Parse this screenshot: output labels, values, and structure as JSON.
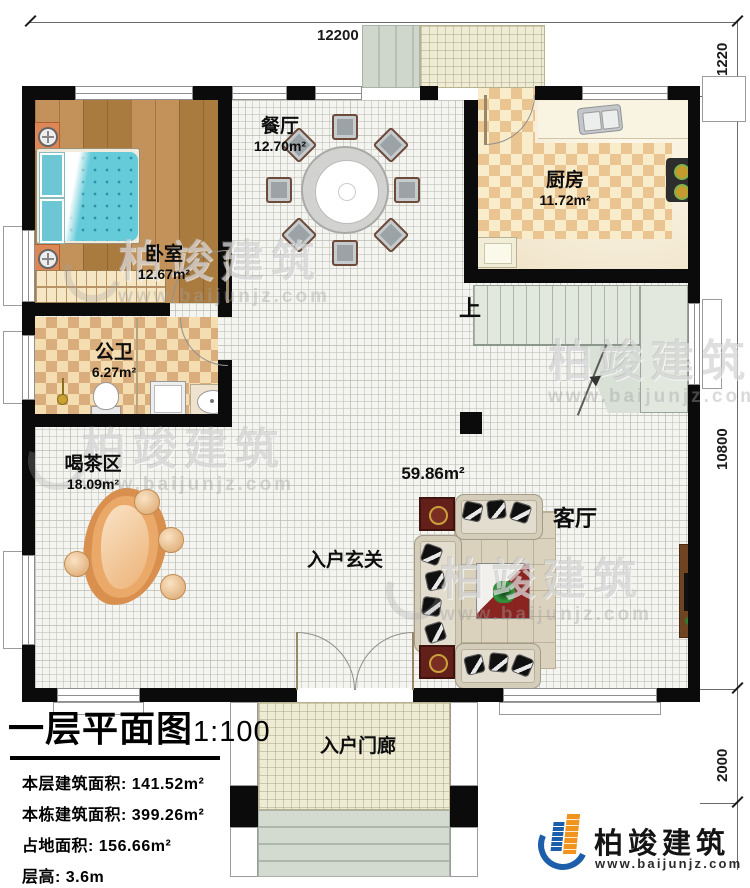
{
  "dims": {
    "top": "12200",
    "right": [
      "1220",
      "10800",
      "2000"
    ]
  },
  "rooms": {
    "dining": {
      "name": "餐厅",
      "area": "12.70m²"
    },
    "kitchen": {
      "name": "厨房",
      "area": "11.72m²"
    },
    "bedroom": {
      "name": "卧室",
      "area": "12.67m²"
    },
    "bathroom": {
      "name": "公卫",
      "area": "6.27m²"
    },
    "tea": {
      "name": "喝茶区",
      "area": "18.09m²"
    },
    "living": {
      "name": "客厅",
      "area": "59.86m²"
    },
    "foyer": {
      "name": "入户玄关"
    },
    "porch": {
      "name": "入户门廊"
    }
  },
  "stairs": {
    "up": "上"
  },
  "title_block": {
    "title": "一层平面图",
    "scale": "1:100",
    "lines": [
      "本层建筑面积: 141.52m²",
      "本栋建筑面积: 399.26m²",
      "占地面积: 156.66m²",
      "层高: 3.6m"
    ]
  },
  "brand": {
    "name": "柏竣建筑",
    "url": "www.baijunjz.com"
  },
  "colors": {
    "wall": "#0b0b0b",
    "wood_floor": "#b5854b",
    "checker_tile": "#d9ad7c",
    "bed_teal": "#66cbd9",
    "stairs_green": "#e3e8df",
    "coffee_table_red": "#8a2420",
    "logo_blue": "#1c5ea9",
    "logo_orange": "#f0941d"
  }
}
